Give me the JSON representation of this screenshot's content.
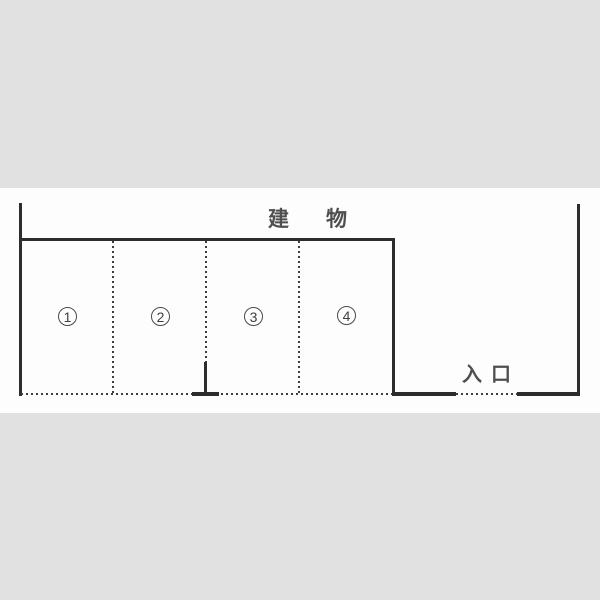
{
  "diagram": {
    "building_label": "建物",
    "entrance_label": "入口",
    "spaces": [
      {
        "id": 1,
        "label": "1"
      },
      {
        "id": 2,
        "label": "2"
      },
      {
        "id": 3,
        "label": "3"
      },
      {
        "id": 4,
        "label": "4"
      }
    ],
    "colors": {
      "page_background": "#e1e1e1",
      "drawing_background": "#fdfdfd",
      "line": "#2d2d2d",
      "dotted_line": "#3e3e3e",
      "text": "#4f4f4f"
    }
  }
}
